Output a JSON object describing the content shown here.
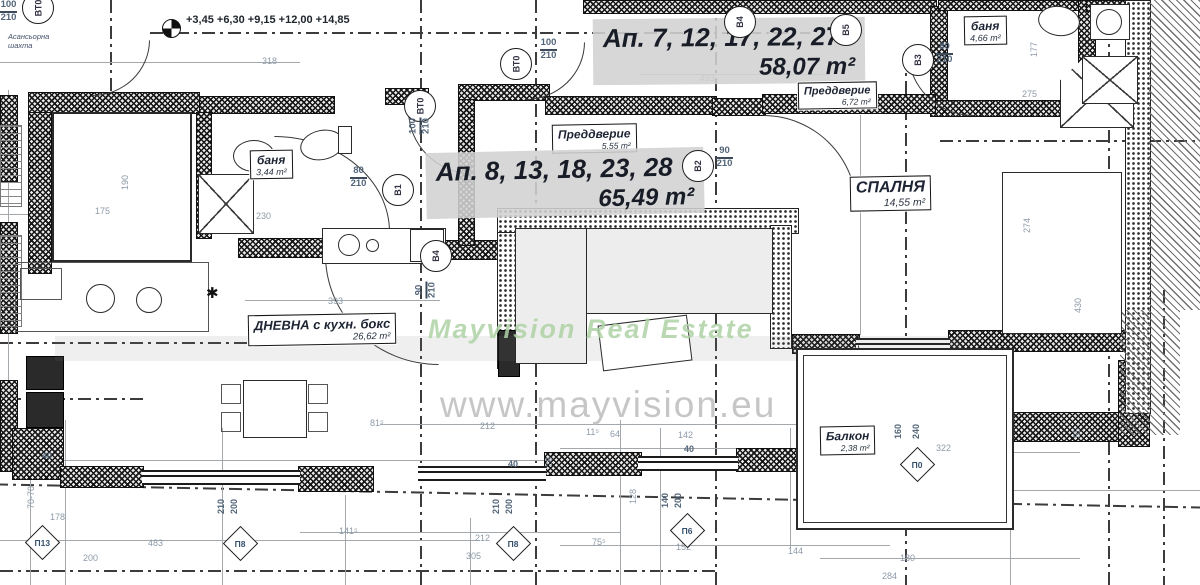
{
  "watermarks": {
    "brand": "Mayvision Real Estate",
    "url": "www.mayvision.eu"
  },
  "levels": {
    "marks": "+3,45 +6,30 +9,15 +12,00 +14,85"
  },
  "note": {
    "line1": "Асансьорна",
    "line2": "шахта"
  },
  "apartments": [
    {
      "title": "Ап. 7, 12, 17, 22, 27",
      "area": "58,07 m²"
    },
    {
      "title": "Ап. 8, 13, 18, 23, 28",
      "area": "65,49 m²"
    }
  ],
  "rooms": {
    "preddverie_top": {
      "name": "Преддверие",
      "area": "6,72 m²"
    },
    "preddverie_mid": {
      "name": "Преддверие",
      "area": "5,55 m²"
    },
    "banya_left": {
      "name": "баня",
      "area": "3,44 m²"
    },
    "banya_right": {
      "name": "баня",
      "area": "4,66 m²"
    },
    "spalnya": {
      "name": "СПАЛНЯ",
      "area": "14,55 m²"
    },
    "dnevna": {
      "name": "ДНЕВНА с кухн. бокс",
      "area": "26,62 m²"
    },
    "balkon": {
      "name": "Балкон",
      "area": "2,38 m²"
    }
  },
  "doors": {
    "vt0_top_left": {
      "id": "ВТ0",
      "size_w": "100",
      "size_h": "210"
    },
    "vt0_upper": {
      "id": "ВТ0",
      "size_w": "100",
      "size_h": "210"
    },
    "vt0_hall": {
      "id": "ВТ0",
      "size_w": "100",
      "size_h": "210"
    },
    "v1": {
      "id": "В1",
      "size_w": "80",
      "size_h": "210"
    },
    "v2": {
      "id": "В2",
      "size_w": "90",
      "size_h": "210"
    },
    "v3": {
      "id": "В3",
      "size_w": "80",
      "size_h": "210"
    },
    "v4": {
      "id": "В4",
      "size_w": "90",
      "size_h": "210"
    },
    "v4_upper": {
      "id": "В4"
    },
    "v5_upper": {
      "id": "В5"
    }
  },
  "windows": {
    "p13": {
      "id": "П13"
    },
    "p8_left": {
      "id": "П8"
    },
    "p8_mid": {
      "id": "П8"
    },
    "p6": {
      "id": "П6"
    },
    "p0": {
      "id": "П0"
    }
  },
  "dims": [
    "318",
    "493",
    "230",
    "393",
    "175",
    "190",
    "212",
    "11⁵",
    "64",
    "142",
    "40",
    "40",
    "40",
    "178",
    "483",
    "200",
    "212",
    "305",
    "141⁵",
    "75⁵",
    "152",
    "144",
    "322",
    "180",
    "284",
    "275",
    "177",
    "274",
    "430",
    "70-70",
    "28",
    "128",
    "55",
    "81⁵",
    "160",
    "240",
    "210",
    "200",
    "210",
    "200",
    "140",
    "200"
  ]
}
